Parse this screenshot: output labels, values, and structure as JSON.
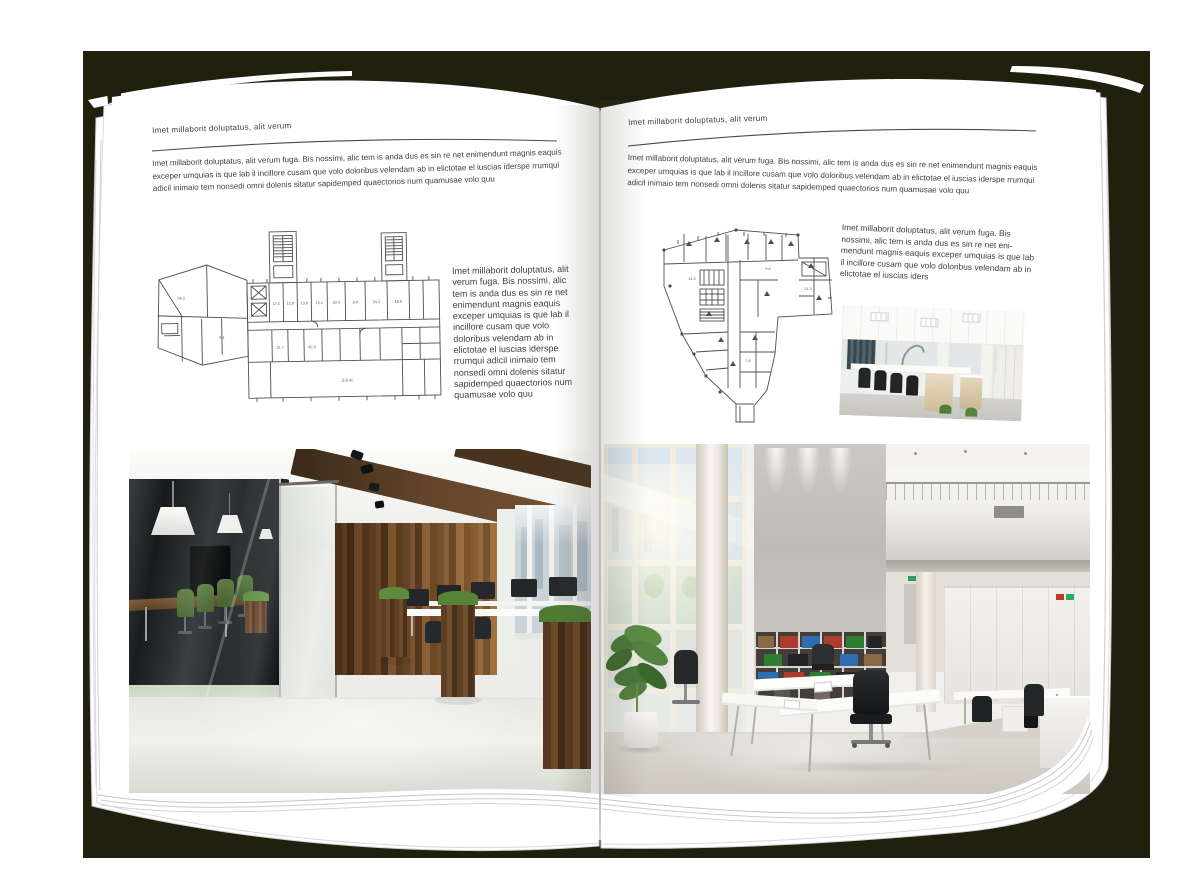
{
  "colors": {
    "backdrop": "#21200f",
    "page": "#ffffff",
    "text": "#3e3e3e"
  },
  "left_page": {
    "header": "Imet millaborit doluptatus, alit verum",
    "intro": "Imet millaborit doluptatus, alit verum fuga. Bis nossimi, alic tem is anda dus es sin re net enimendunt magnis eaquis exceper umquias is que lab il incillore cusam que volo doloribus velendam ab in elictotae el iuscias iderspe rrumqui adicil inimaio tem nonsedi omni dolenis sitatur sapidemped quaectorios num quamusae volo quu",
    "side_text": "Imet millaborit doluptatus, alit verum fuga. Bis nossimi, alic tem is anda dus es sin re net enimendunt magnis eaquis exceper umquias is que lab il incillore cusam que volo doloribus velendam ab in elictotae el iuscias iderspe rrumqui adicil inimaio tem nonsedi omni dolenis sitatur sapidemped quaectorios num quamusae volo quu",
    "floor_plan_label": "2-й эт.",
    "room_numbers": [
      "17.2",
      "12.8",
      "13.6",
      "15.1",
      "20.4",
      "8.4",
      "24.3",
      "18.9",
      "31.7",
      "42.6",
      "56.2",
      "9.1"
    ]
  },
  "right_page": {
    "header": "Imet millaborit doluptatus, alit verum",
    "intro": "Imet millaborit doluptatus, alit verum fuga. Bis nossimi, alic tem is anda dus es sin re net enimendunt magnis eaquis exceper umquias is que lab il incillore cusam que volo doloribus velendam ab in elictotae el iuscias iderspe rrumqui adicil inimaio tem nonsedi omni dolenis sitatur sapidemped quaectorios num quamusae volo quu",
    "side_text": "Imet millaborit doluptatus, alit verum fuga. Bis nossimi, alic tem is anda dus es sin re net eni-mendunt magnis eaquis exceper umquias is que lab il incillore cusam que volo doloribus velendam ab in elictotae el iuscias iders",
    "room_numbers": [
      "14.2",
      "9.6",
      "21.3",
      "7.8"
    ]
  }
}
